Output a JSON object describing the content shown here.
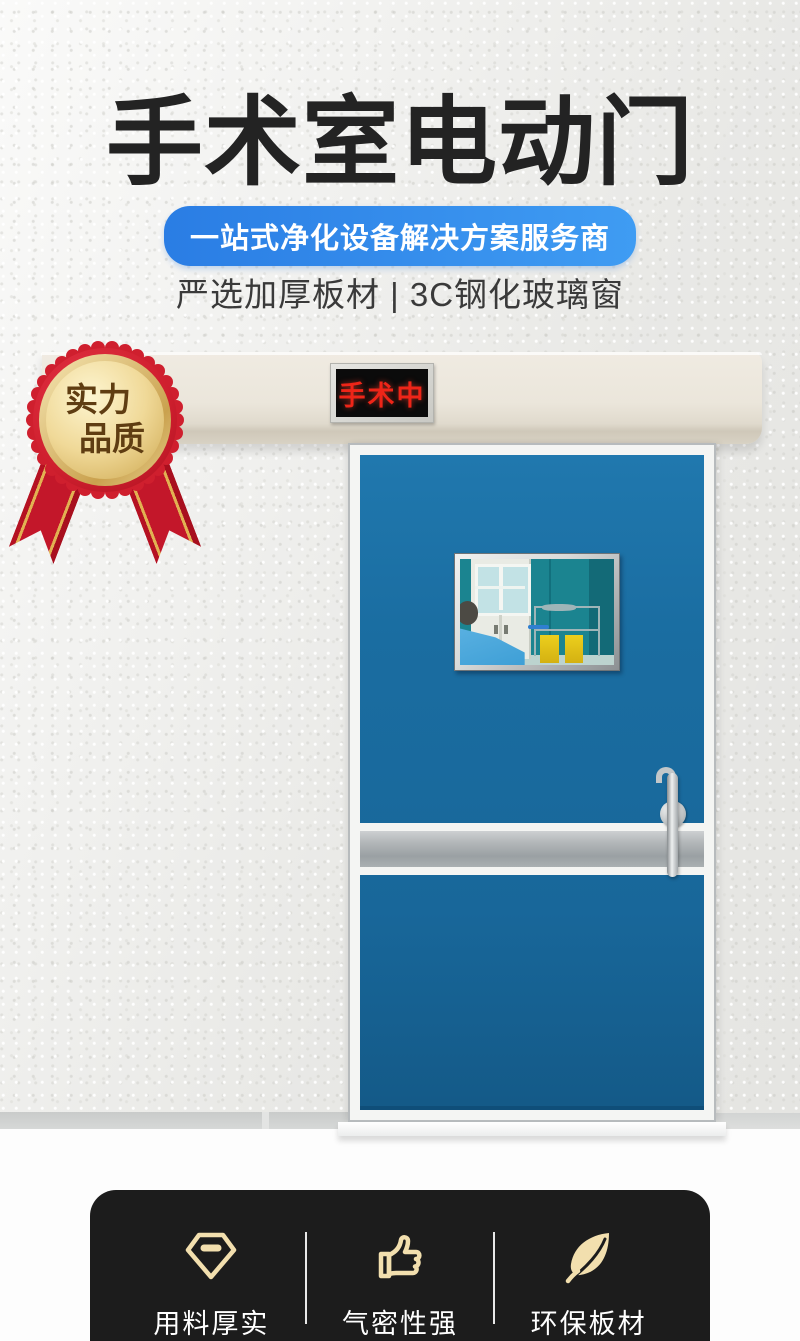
{
  "hero": {
    "title": "手术室电动门",
    "tagline": "一站式净化设备解决方案服务商",
    "subtitle": "严选加厚板材 | 3C钢化玻璃窗"
  },
  "badge": {
    "line1": "实力",
    "line2": "品质"
  },
  "door": {
    "status_sign": "手术中"
  },
  "features": {
    "items": [
      {
        "icon": "diamond-icon",
        "label": "用料厚实"
      },
      {
        "icon": "thumbs-up-icon",
        "label": "气密性强"
      },
      {
        "icon": "leaf-icon",
        "label": "环保板材"
      }
    ]
  },
  "colors": {
    "accent-blue": "#2e86ea",
    "door-blue": "#1a6da1",
    "sign-red": "#ee2518",
    "badge-red": "#cf1f2e",
    "badge-gold": "#f0d998",
    "feature-gold": "#f2dfae",
    "panel-black": "#1c1c1c",
    "beam-cream": "#ebe6db"
  }
}
